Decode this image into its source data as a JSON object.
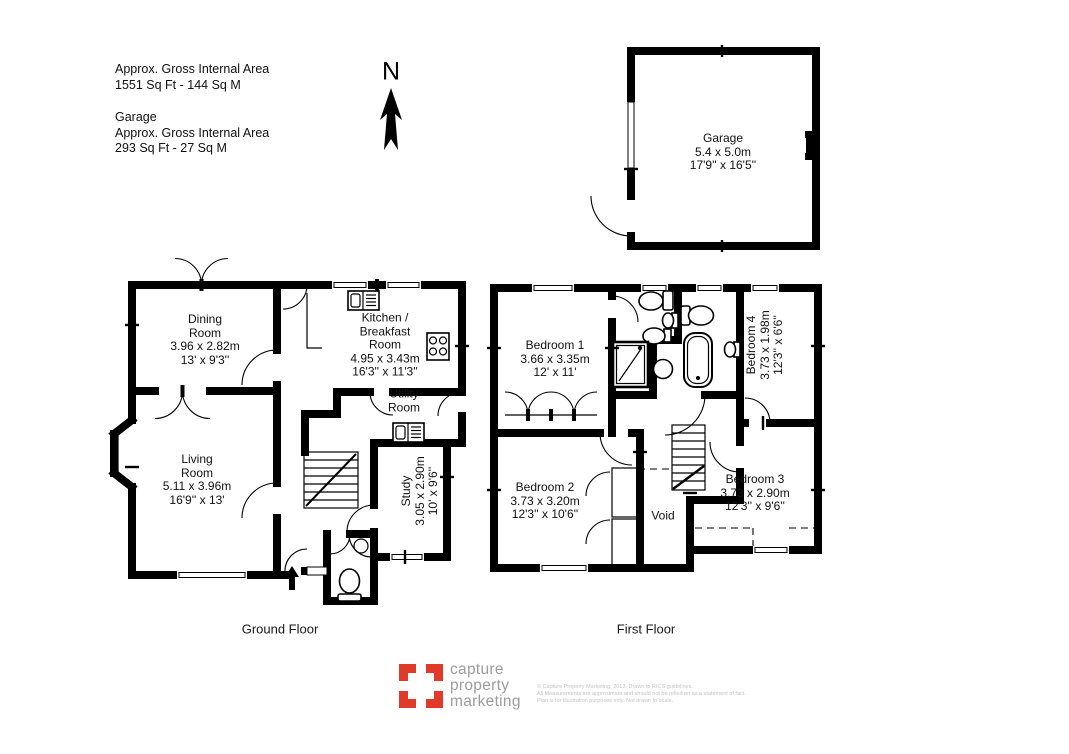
{
  "header": {
    "north_label": "N",
    "total_area": {
      "line1": "Approx. Gross Internal Area",
      "line2": "1551 Sq Ft  -  144 Sq M"
    },
    "garage_area": {
      "title": "Garage",
      "line1": "Approx. Gross Internal Area",
      "line2": "293 Sq Ft  - 27 Sq M"
    }
  },
  "garage_plan": {
    "room": {
      "name": "Garage",
      "metric": "5.4 x 5.0m",
      "imperial": "17'9'' x 16'5''"
    }
  },
  "ground_floor": {
    "caption": "Ground Floor",
    "rooms": {
      "dining": {
        "name1": "Dining",
        "name2": "Room",
        "metric": "3.96 x 2.82m",
        "imperial": "13' x 9'3''"
      },
      "kitchen": {
        "name1": "Kitchen /",
        "name2": "Breakfast",
        "name3": "Room",
        "metric": "4.95 x 3.43m",
        "imperial": "16'3'' x 11'3''"
      },
      "utility": {
        "name1": "Utility",
        "name2": "Room"
      },
      "living": {
        "name1": "Living",
        "name2": "Room",
        "metric": "5.11 x 3.96m",
        "imperial": "16'9'' x 13'"
      },
      "study": {
        "name": "Study",
        "metric": "3.05 x 2.90m",
        "imperial": "10' x 9'6''"
      }
    }
  },
  "first_floor": {
    "caption": "First Floor",
    "rooms": {
      "bedroom1": {
        "name": "Bedroom 1",
        "metric": "3.66 x 3.35m",
        "imperial": "12' x 11'"
      },
      "bedroom2": {
        "name": "Bedroom 2",
        "metric": "3.73 x 3.20m",
        "imperial": "12'3'' x 10'6''"
      },
      "bedroom3": {
        "name": "Bedroom 3",
        "metric": "3.73 x 2.90m",
        "imperial": "12'3'' x 9'6''"
      },
      "bedroom4": {
        "name": "Bedroom 4",
        "metric": "3.73 x 1.98m",
        "imperial": "12'3'' x 6'6''"
      },
      "void": {
        "name": "Void"
      }
    }
  },
  "footer": {
    "brand": {
      "line1": "capture",
      "line2": "property",
      "line3": "marketing"
    },
    "disclaimer": {
      "line1": "© Capture Property Marketing, 2013. Drawn to RICS guidelines.",
      "line2": "All Measurements are approximate and should not be relied on as a statement of fact.",
      "line3": "Plan is for illustration purposes only. Not drawn to scale."
    }
  },
  "colors": {
    "brand_red": "#e03a2a",
    "brand_gray": "#9d9d9d",
    "wall": "#000000"
  }
}
